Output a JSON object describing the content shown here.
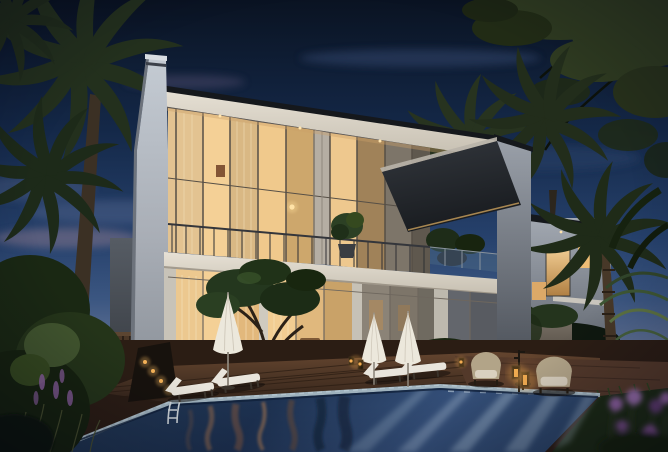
{
  "scene": {
    "description": "Dusk architectural rendering of a modern two-storey villa with warmly lit glass facades, palm trees, a wooden pool deck with white sun loungers and umbrellas, wicker lounge chairs with glowing lanterns, and a swimming pool in the foreground; a second lit villa sits behind to the right under a deep blue evening sky",
    "time_of_day": "dusk",
    "objects": [
      "evening-sky",
      "clouds",
      "overhanging-tree-canopy",
      "background-palms",
      "left-palm-tree",
      "background-villa",
      "right-palm-tree",
      "garden-wall",
      "main-villa",
      "fin-wall",
      "roof-slab",
      "upper-floor-glazing",
      "balcony",
      "dark-canopy",
      "roof-terrace",
      "ground-floor-glazing",
      "wood-fence",
      "path-lights",
      "frangipani-tree",
      "shrubs",
      "wood-deck",
      "terracotta-paving",
      "swimming-pool",
      "pool-ladder",
      "sun-loungers",
      "patio-umbrellas",
      "wicker-seating",
      "lanterns",
      "lawn",
      "foreground-flowers",
      "left-garden"
    ]
  },
  "palette": {
    "sky_top": "#0a1322",
    "sky_mid": "#142848",
    "sky_low": "#26416c",
    "sky_horizon": "#5b6e92",
    "cloud_pink": "#8d7a90",
    "cloud_blue": "#64749a",
    "foliage_dark": "#141f12",
    "foliage_mid": "#243419",
    "foliage_lit": "#41552e",
    "canopy_olive": "#2e3a20",
    "palm_dim": "#27331f",
    "trunk": "#3b3024",
    "villa_fascia": "#e7e1d5",
    "roof_edge": "#15181c",
    "fin_light": "#c4cbd3",
    "fin_dark": "#6d737c",
    "frame_dark": "#564f46",
    "glass_bright": "#f4d096",
    "glass_warm": "#e2b87c",
    "curtain_stripe": "#f3e4c0",
    "glass_dusk": "#7d7569",
    "annex_gray": "#565c64",
    "fence_wood": "#4a3626",
    "end_wall": "#9aa0a9",
    "canopy_dark": "#191c20",
    "bg_villa_wall": "#a2a8b1",
    "window_warm": "#eebd76",
    "garden_wall": "#847b6f",
    "deck_wood": "#64452f",
    "deck_dark": "#33241a",
    "paving": "#53392a",
    "pool_deep": "#1d3150",
    "pool_mid": "#35507a",
    "pool_beam": "#cfe3f2",
    "pool_warm": "#a4714a",
    "coping": "#9fb2bd",
    "lounger": "#e9e5dc",
    "umbrella": "#ece8dc",
    "wicker": "#b2a488",
    "cushion": "#d9d0bf",
    "lantern_glow": "#f5b054",
    "grass": "#1c2a15",
    "flower_purple": "#8a5f9c",
    "glow_warm": "#ffe4ae"
  }
}
